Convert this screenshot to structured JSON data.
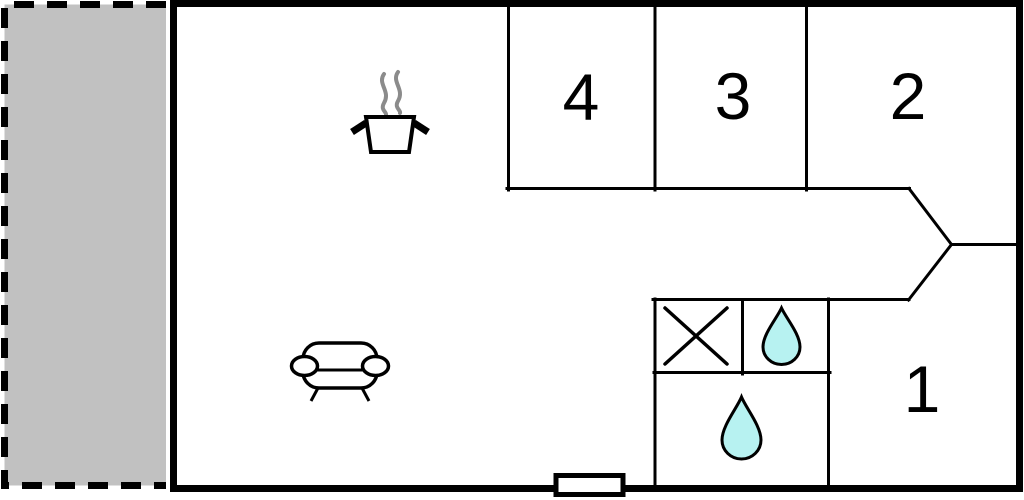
{
  "floorplan": {
    "rooms": [
      {
        "label": "4"
      },
      {
        "label": "3"
      },
      {
        "label": "2"
      },
      {
        "label": "1"
      }
    ],
    "icons": [
      "stove-pot-steam-icon",
      "sofa-icon",
      "shower-cross-icon",
      "water-drop-icon-small",
      "water-drop-icon-large"
    ],
    "colors": {
      "wall": "#000000",
      "terrace_fill": "#c1c1c1",
      "drop_fill": "#b7f2f1",
      "steam_gray": "#8b8b8b",
      "background": "#ffffff"
    }
  }
}
